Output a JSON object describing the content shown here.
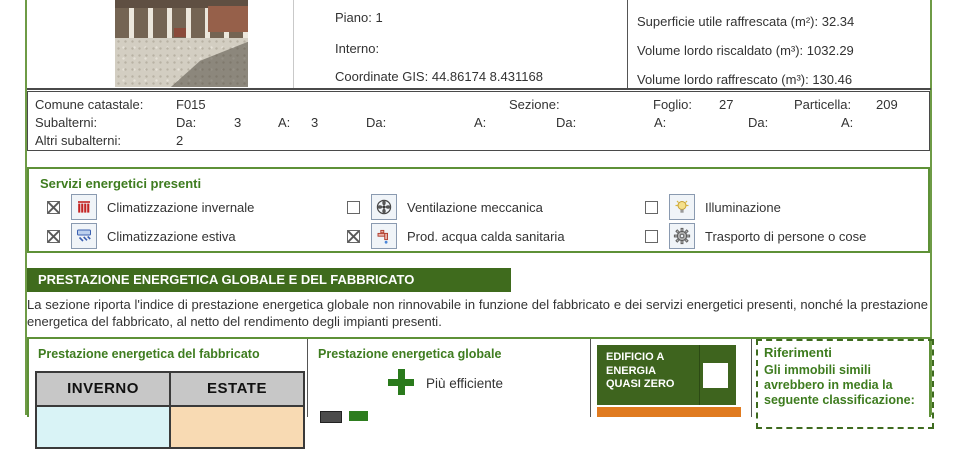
{
  "property": {
    "fields_left": [
      {
        "label": "Piano:",
        "value": "1"
      },
      {
        "label": "Interno:",
        "value": ""
      },
      {
        "label": "Coordinate GIS:",
        "value": "44.86174 8.431168"
      }
    ],
    "fields_right": [
      {
        "label": "Superficie utile raffrescata (m²):",
        "value": "32.34"
      },
      {
        "label": "Volume lordo riscaldato (m³):",
        "value": "1032.29"
      },
      {
        "label": "Volume lordo raffrescato (m³):",
        "value": "130.46"
      }
    ]
  },
  "catastale": {
    "comune_label": "Comune catastale:",
    "comune_value": "F015",
    "sezione_label": "Sezione:",
    "sezione_value": "",
    "foglio_label": "Foglio:",
    "foglio_value": "27",
    "particella_label": "Particella:",
    "particella_value": "209",
    "subalterni_label": "Subalterni:",
    "subalterni_pairs": [
      {
        "label": "Da:",
        "value": "3"
      },
      {
        "label": "A:",
        "value": "3"
      },
      {
        "label": "Da:",
        "value": ""
      },
      {
        "label": "A:",
        "value": ""
      },
      {
        "label": "Da:",
        "value": ""
      },
      {
        "label": "A:",
        "value": ""
      },
      {
        "label": "Da:",
        "value": ""
      },
      {
        "label": "A:",
        "value": ""
      }
    ],
    "altri_label": "Altri subalterni:",
    "altri_value": "2"
  },
  "services": {
    "title": "Servizi energetici presenti",
    "items": [
      {
        "label": "Climatizzazione invernale",
        "checked": true,
        "icon": "radiator-icon"
      },
      {
        "label": "Ventilazione meccanica",
        "checked": false,
        "icon": "fan-icon"
      },
      {
        "label": "Illuminazione",
        "checked": false,
        "icon": "lightbulb-icon"
      },
      {
        "label": "Climatizzazione estiva",
        "checked": true,
        "icon": "air-conditioner-icon"
      },
      {
        "label": "Prod. acqua calda sanitaria",
        "checked": true,
        "icon": "faucet-icon"
      },
      {
        "label": "Trasporto di persone o cose",
        "checked": false,
        "icon": "gear-icon"
      }
    ]
  },
  "section": {
    "header": "PRESTAZIONE ENERGETICA GLOBALE E DEL FABBRICATO",
    "description": "La sezione riporta l'indice di prestazione energetica globale non rinnovabile in funzione del fabbricato e dei servizi energetici presenti, nonché la prestazione energetica del fabbricato, al netto del rendimento degli impianti presenti."
  },
  "fabbricato": {
    "title": "Prestazione energetica del fabbricato",
    "columns": [
      "INVERNO",
      "ESTATE"
    ]
  },
  "globale": {
    "title": "Prestazione energetica globale",
    "more_efficient": "Più efficiente"
  },
  "nzeb": {
    "line1": "EDIFICIO A",
    "line2": "ENERGIA",
    "line3": "QUASI ZERO",
    "checked": false
  },
  "riferimenti": {
    "title": "Riferimenti",
    "text": "Gli immobili simili avrebbero in media la seguente classificazione:"
  },
  "colors": {
    "accent_green": "#3e7c1f",
    "header_green": "#3f6b1d",
    "badge_green": "#3e641e",
    "page_border_green": "#6e9b46",
    "class_orange": "#e07b20",
    "winter_cell": "#d9f3f6",
    "summer_cell": "#f8dab3"
  }
}
